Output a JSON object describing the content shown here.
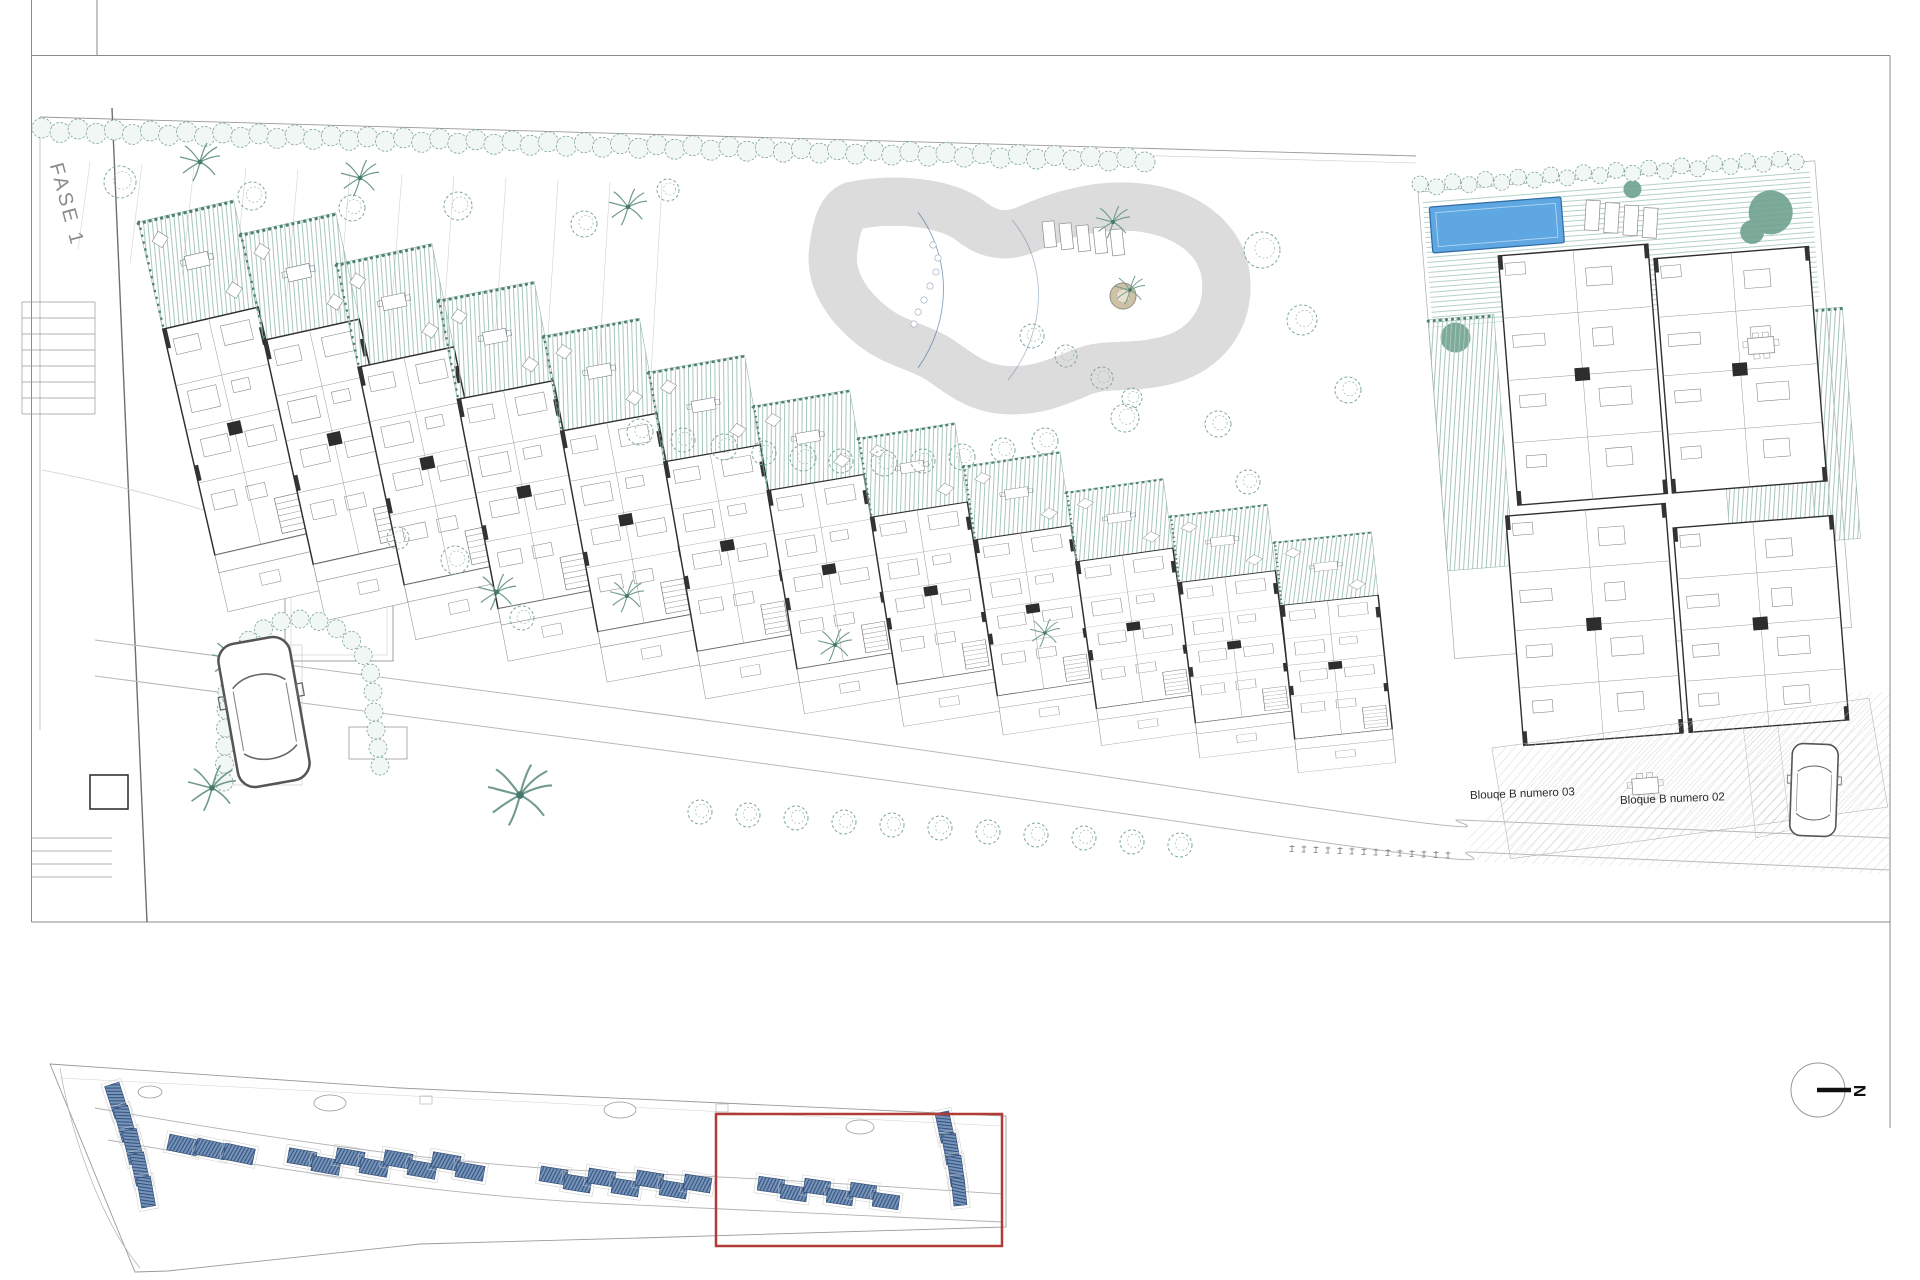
{
  "drawing": {
    "labels": {
      "phase": {
        "text": "FASE 1",
        "x": 55,
        "y": 152,
        "rot": 75
      },
      "blocks": [
        {
          "text": "Blouqe B numero 03",
          "x": 1470,
          "y": 790,
          "rot": -2
        },
        {
          "text": "Bloque B numero 02",
          "x": 1620,
          "y": 795,
          "rot": -2
        }
      ],
      "north": {
        "text": "N",
        "x": 1853,
        "y": 1081,
        "rot": 90
      }
    },
    "colors": {
      "paper": "#ffffff",
      "wall": "#2f2f2f",
      "line_light": "#aaaaaa",
      "teal": "#5f8f82",
      "teal_light": "#a6c6b9",
      "pool_edge": "#1d4c85",
      "pool_deep": "#2b5b95",
      "pool_light": "#86abd2",
      "small_pool": "#5ea7e3",
      "island": "#cdc2a6",
      "minimap_roof": "#7693ba",
      "minimap_roof_hatch": "#33517b",
      "red_box": "#b23b35"
    },
    "site": {
      "cascade": [
        {
          "x": 138,
          "y": 222,
          "rot": -13,
          "sy": 1.0
        },
        {
          "x": 240,
          "y": 234,
          "rot": -12.5,
          "sy": 0.99
        },
        {
          "x": 336,
          "y": 264,
          "rot": -12,
          "sy": 0.96
        },
        {
          "x": 438,
          "y": 300,
          "rot": -11,
          "sy": 0.92
        },
        {
          "x": 543,
          "y": 336,
          "rot": -10.5,
          "sy": 0.88
        },
        {
          "x": 648,
          "y": 372,
          "rot": -10,
          "sy": 0.83
        },
        {
          "x": 753,
          "y": 406,
          "rot": -9.5,
          "sy": 0.78
        },
        {
          "x": 858,
          "y": 438,
          "rot": -9,
          "sy": 0.73
        },
        {
          "x": 963,
          "y": 466,
          "rot": -8.5,
          "sy": 0.68
        },
        {
          "x": 1066,
          "y": 492,
          "rot": -8,
          "sy": 0.64
        },
        {
          "x": 1170,
          "y": 516,
          "rot": -7,
          "sy": 0.61
        },
        {
          "x": 1274,
          "y": 542,
          "rot": -6,
          "sy": 0.58
        }
      ],
      "complex": {
        "origin": {
          "x": 1418,
          "y": 192,
          "rot": -4.5
        },
        "blocks": [
          {
            "x": 75,
            "y": 70,
            "w": 150,
            "h": 250
          },
          {
            "x": 230,
            "y": 85,
            "w": 155,
            "h": 235
          },
          {
            "x": 62,
            "y": 330,
            "w": 160,
            "h": 230
          },
          {
            "x": 228,
            "y": 355,
            "w": 160,
            "h": 205
          }
        ],
        "gardens": [
          {
            "x": 0,
            "y": 128,
            "w": 66,
            "h": 252
          },
          {
            "x": 370,
            "y": 148,
            "w": 44,
            "h": 232
          },
          {
            "x": 284,
            "y": 284,
            "w": 102,
            "h": 106
          }
        ]
      },
      "trees": [
        [
          120,
          182,
          16
        ],
        [
          252,
          196,
          14
        ],
        [
          352,
          208,
          13
        ],
        [
          458,
          206,
          14
        ],
        [
          584,
          224,
          13
        ],
        [
          668,
          190,
          11
        ],
        [
          1262,
          250,
          18
        ],
        [
          1302,
          320,
          15
        ],
        [
          1348,
          390,
          13
        ],
        [
          1218,
          424,
          13
        ],
        [
          1248,
          482,
          12
        ],
        [
          455,
          560,
          14
        ],
        [
          398,
          538,
          11
        ],
        [
          522,
          618,
          12
        ],
        [
          1032,
          336,
          12
        ],
        [
          1066,
          356,
          11
        ],
        [
          1102,
          378,
          11
        ],
        [
          1132,
          398,
          10
        ],
        [
          640,
          432,
          13
        ],
        [
          683,
          440,
          12
        ],
        [
          724,
          447,
          13
        ],
        [
          764,
          453,
          12
        ],
        [
          803,
          458,
          13
        ],
        [
          841,
          461,
          12
        ],
        [
          884,
          463,
          13
        ],
        [
          923,
          461,
          12
        ],
        [
          962,
          457,
          13
        ],
        [
          1003,
          450,
          12
        ],
        [
          1045,
          441,
          13
        ],
        [
          1125,
          418,
          14
        ],
        [
          700,
          812,
          12
        ],
        [
          748,
          815,
          12
        ],
        [
          796,
          818,
          12
        ],
        [
          844,
          822,
          12
        ],
        [
          892,
          825,
          12
        ],
        [
          940,
          828,
          12
        ],
        [
          988,
          832,
          12
        ],
        [
          1036,
          835,
          12
        ],
        [
          1084,
          838,
          12
        ],
        [
          1132,
          842,
          12
        ],
        [
          1180,
          845,
          12
        ]
      ],
      "palms": [
        [
          200,
          162,
          20
        ],
        [
          360,
          178,
          19
        ],
        [
          628,
          207,
          19
        ],
        [
          233,
          660,
          21
        ],
        [
          497,
          592,
          19
        ],
        [
          627,
          596,
          17
        ],
        [
          835,
          645,
          17
        ],
        [
          1045,
          633,
          15
        ],
        [
          1113,
          222,
          17
        ],
        [
          1130,
          290,
          15
        ],
        [
          520,
          795,
          32
        ],
        [
          212,
          788,
          24
        ]
      ],
      "hedge_top": {
        "x1": 42,
        "y1": 130,
        "x2": 1145,
        "y2": 160,
        "r": 10,
        "step": 18
      },
      "hedge_complex": {
        "x1": 1420,
        "y1": 186,
        "x2": 1796,
        "y2": 160,
        "r": 8,
        "step": 16
      },
      "loungers_pool": {
        "x": 1042,
        "y": 222,
        "count": 5,
        "dx": 17,
        "dy": 2
      },
      "ticks": {
        "x": 1292,
        "y": 845,
        "count": 14,
        "step": 12
      },
      "cars": [
        {
          "x": 264,
          "y": 712,
          "rot": -10,
          "s": 0.82
        },
        {
          "x": 1814,
          "y": 790,
          "rot": 2,
          "s": 0.52
        }
      ]
    },
    "minimap": {
      "red_rect": {
        "x": 716,
        "y": 1114,
        "w": 286,
        "h": 132
      },
      "ponds": [
        [
          150,
          1092,
          12,
          6
        ],
        [
          330,
          1103,
          16,
          8
        ],
        [
          620,
          1110,
          16,
          8
        ],
        [
          860,
          1127,
          14,
          7
        ]
      ],
      "buildings": [
        [
          100,
          1093,
          34,
          15,
          72
        ],
        [
          108,
          1116,
          34,
          15,
          74
        ],
        [
          116,
          1139,
          34,
          15,
          76
        ],
        [
          124,
          1162,
          32,
          14,
          78
        ],
        [
          131,
          1185,
          30,
          14,
          80
        ],
        [
          168,
          1137,
          30,
          16,
          12
        ],
        [
          196,
          1141,
          30,
          16,
          12
        ],
        [
          224,
          1146,
          30,
          16,
          12
        ],
        [
          288,
          1150,
          28,
          15,
          10
        ],
        [
          312,
          1158,
          28,
          15,
          10
        ],
        [
          336,
          1150,
          28,
          15,
          10
        ],
        [
          360,
          1160,
          28,
          15,
          10
        ],
        [
          384,
          1152,
          28,
          15,
          10
        ],
        [
          408,
          1162,
          28,
          15,
          10
        ],
        [
          432,
          1154,
          28,
          15,
          10
        ],
        [
          456,
          1164,
          28,
          15,
          10
        ],
        [
          540,
          1168,
          27,
          15,
          9
        ],
        [
          564,
          1176,
          27,
          15,
          9
        ],
        [
          588,
          1170,
          27,
          15,
          9
        ],
        [
          612,
          1180,
          27,
          15,
          9
        ],
        [
          636,
          1172,
          27,
          15,
          9
        ],
        [
          660,
          1182,
          27,
          15,
          9
        ],
        [
          684,
          1176,
          27,
          15,
          9
        ],
        [
          758,
          1178,
          26,
          14,
          8
        ],
        [
          781,
          1186,
          26,
          14,
          8
        ],
        [
          804,
          1180,
          26,
          14,
          8
        ],
        [
          827,
          1190,
          26,
          14,
          8
        ],
        [
          850,
          1184,
          26,
          14,
          8
        ],
        [
          873,
          1194,
          26,
          14,
          8
        ],
        [
          930,
          1120,
          30,
          14,
          78
        ],
        [
          936,
          1142,
          30,
          14,
          80
        ],
        [
          941,
          1164,
          30,
          14,
          82
        ],
        [
          945,
          1185,
          28,
          13,
          84
        ]
      ]
    }
  }
}
